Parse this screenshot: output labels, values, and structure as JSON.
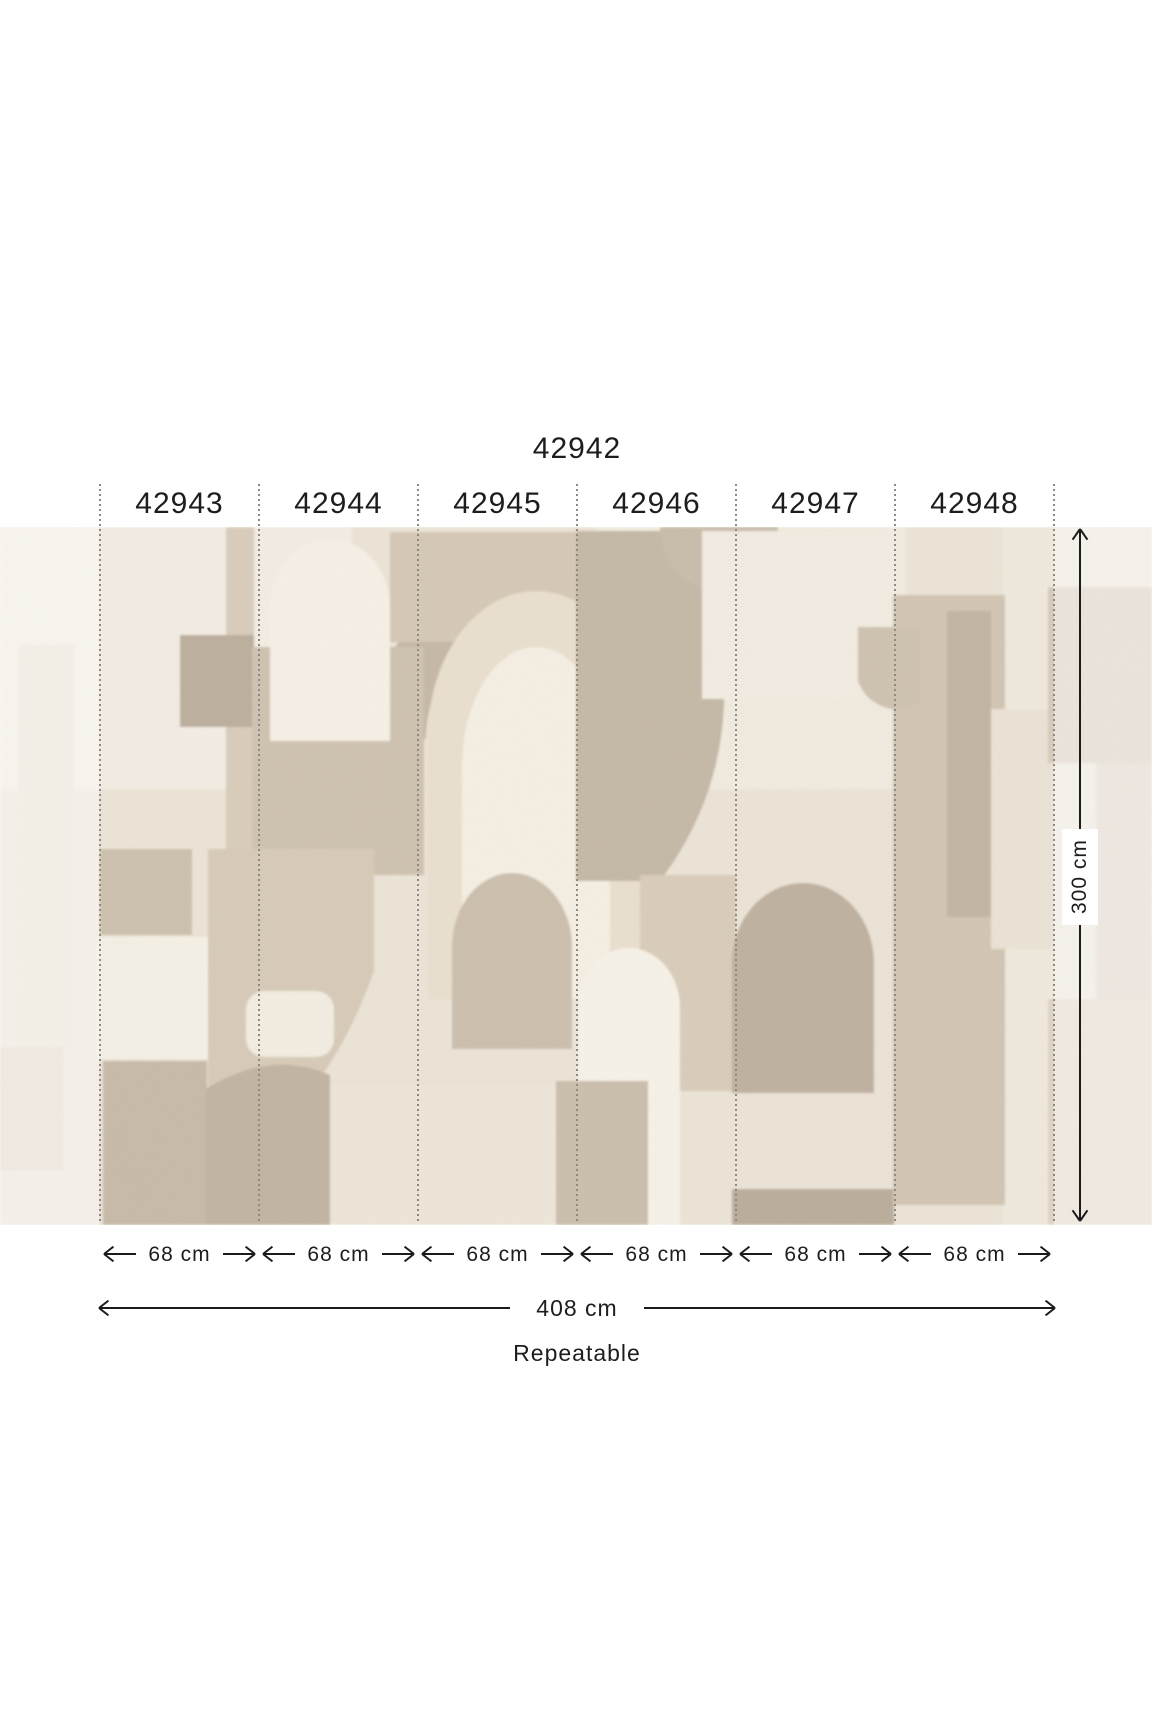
{
  "title": "42942",
  "panels": [
    {
      "label": "42943",
      "width_label": "68 cm"
    },
    {
      "label": "42944",
      "width_label": "68 cm"
    },
    {
      "label": "42945",
      "width_label": "68 cm"
    },
    {
      "label": "42946",
      "width_label": "68 cm"
    },
    {
      "label": "42947",
      "width_label": "68 cm"
    },
    {
      "label": "42948",
      "width_label": "68 cm"
    }
  ],
  "dimensions": {
    "height_label": "300 cm",
    "total_width_label": "408 cm",
    "repeat_label": "Repeatable"
  },
  "icons": {
    "width_arrows": "double-headed-horizontal-dimension-arrow",
    "height_arrow": "double-headed-vertical-dimension-arrow",
    "panel_dividers": "vertical-dotted-cut-lines"
  },
  "colors": {
    "text": "#1e1d1b",
    "arrow": "#1c1b19",
    "dotted_line": "#8d8a84",
    "mural_background": "#EBE3D6",
    "mural_palette": [
      "#F5EFE5",
      "#F2ECE2",
      "#E9DFCF",
      "#D9CCBB",
      "#D5C8B6",
      "#D2C5B3",
      "#CFC2B0",
      "#C5B8A6",
      "#C2B4A2",
      "#BFB1A0",
      "#BDAF9E",
      "#BBAD9B"
    ],
    "fade_overlay": "#FBF9F5"
  }
}
